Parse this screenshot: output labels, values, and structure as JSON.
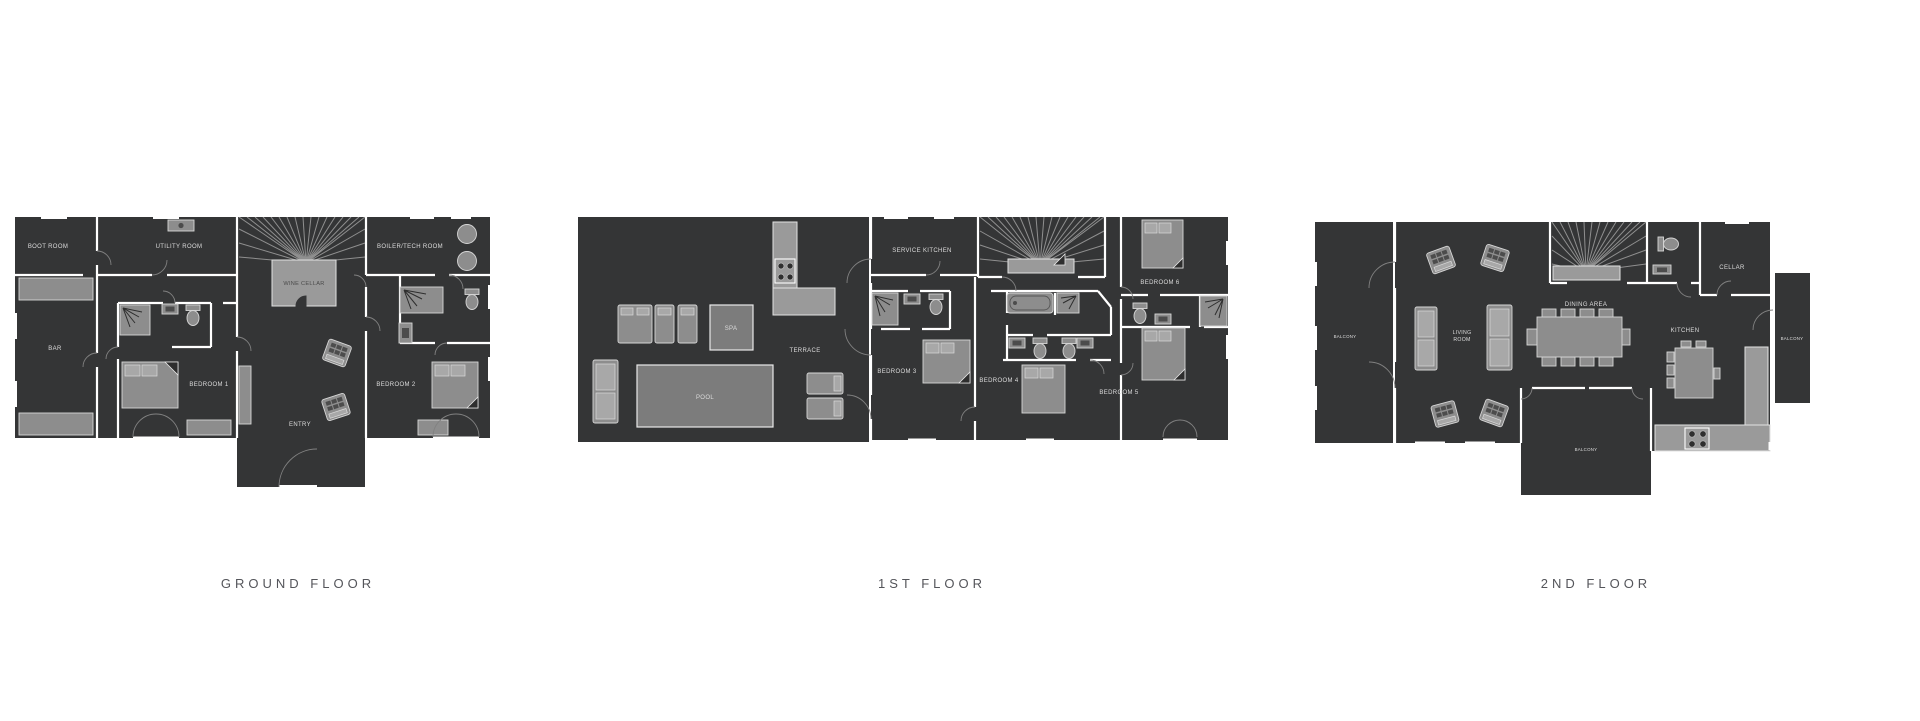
{
  "page": {
    "background": "#ffffff"
  },
  "colors": {
    "plan_background": "#343536",
    "walls": "#ffffff",
    "furniture": "#8d8d8d",
    "furniture_light": "#9a9a9a",
    "pool_fill": "#7c7c7c",
    "room_label": "#dcdcdc",
    "floor_title": "#54555a"
  },
  "floors": {
    "ground": {
      "title": "GROUND FLOOR",
      "rooms": {
        "boot_room": "BOOT ROOM",
        "utility_room": "UTILITY ROOM",
        "wine_cellar": "WINE CELLAR",
        "boiler_tech_room": "BOILER/TECH ROOM",
        "bar": "BAR",
        "bedroom_1": "BEDROOM 1",
        "bedroom_2": "BEDROOM 2",
        "entry": "ENTRY"
      }
    },
    "first": {
      "title": "1ST FLOOR",
      "rooms": {
        "terrace": "TERRACE",
        "pool": "POOL",
        "spa": "SPA",
        "service_kitchen": "SERVICE KITCHEN",
        "bedroom_3": "BEDROOM 3",
        "bedroom_4": "BEDROOM 4",
        "bedroom_5": "BEDROOM 5",
        "bedroom_6": "BEDROOM 6"
      }
    },
    "second": {
      "title": "2ND FLOOR",
      "rooms": {
        "balcony_left": "BALCONY",
        "living_room_line1": "LIVING",
        "living_room_line2": "ROOM",
        "dining_area": "DINING AREA",
        "kitchen": "KITCHEN",
        "cellar": "CELLAR",
        "balcony_right": "BALCONY",
        "balcony_bottom": "BALCONY"
      }
    }
  }
}
